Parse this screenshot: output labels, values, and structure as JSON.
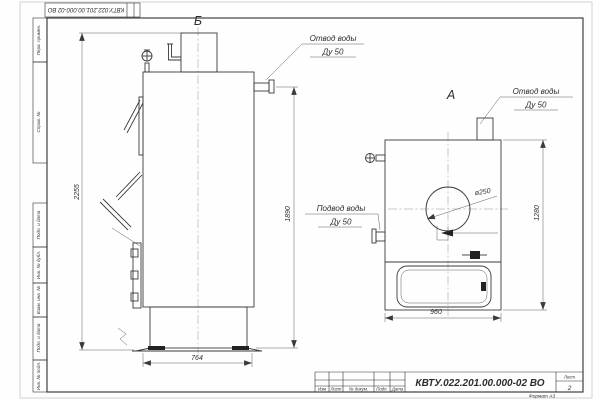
{
  "top_stamp": "КВТУ.022.201.00.000-02 ВО",
  "view_labels": {
    "left": "Б",
    "right": "А"
  },
  "callouts": {
    "outlet_top": {
      "line1": "Отвод воды",
      "line2": "Ду 50"
    },
    "outlet_right": {
      "line1": "Отвод воды",
      "line2": "Ду 50"
    },
    "inlet": {
      "line1": "Подвод воды",
      "line2": "Ду 50"
    }
  },
  "dimensions": {
    "total_height": "2255",
    "outlet_height": "1890",
    "base_width": "764",
    "front_height": "1280",
    "front_width": "960",
    "flue_diameter": "ø250"
  },
  "title_block": {
    "document": "КВТУ.022.201.00.000-02  ВО",
    "columns": [
      "Изм",
      "Лист",
      "№ докум.",
      "Подп.",
      "Дата"
    ],
    "sheet_label": "Лист",
    "sheet_number": "2",
    "format": "Формат А3"
  },
  "margin_boxes": [
    "Перв. примен.",
    "Справ. №",
    "Подп. и дата",
    "Инв. № дубл.",
    "Взам. инв. №",
    "Подп. и дата",
    "Инв. № подл."
  ]
}
